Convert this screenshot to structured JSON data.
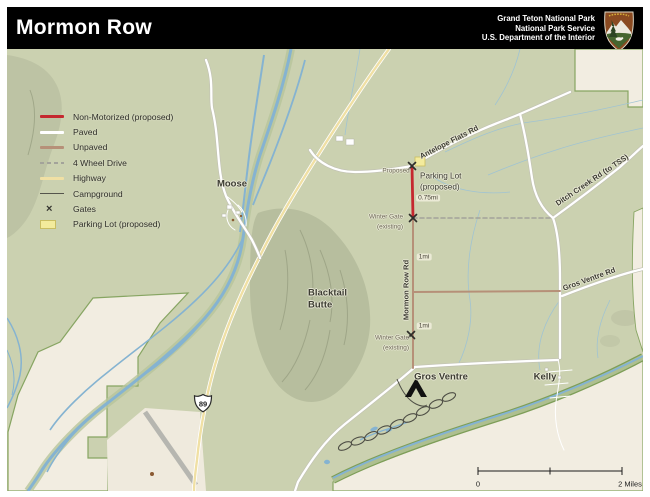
{
  "header": {
    "title": "Mormon Row",
    "agency_lines": [
      "Grand Teton National Park",
      "National Park Service",
      "U.S. Department of the Interior"
    ],
    "logo": "nps-arrowhead-logo"
  },
  "legend": {
    "items": [
      {
        "id": "non-motorized",
        "label": "Non-Motorized (proposed)",
        "swatch": "line",
        "color": "#c5282f"
      },
      {
        "id": "paved",
        "label": "Paved",
        "swatch": "line",
        "color": "#ffffff"
      },
      {
        "id": "unpaved",
        "label": "Unpaved",
        "swatch": "line",
        "color": "#b69078"
      },
      {
        "id": "4-wheel-drive",
        "label": "4 Wheel Drive",
        "swatch": "dash",
        "color": "#a3a39a"
      },
      {
        "id": "highway",
        "label": "Highway",
        "swatch": "line",
        "color": "#f0e0a4"
      },
      {
        "id": "campground",
        "label": "Campground",
        "swatch": "thin",
        "color": "#55554c"
      },
      {
        "id": "gates",
        "label": "Gates",
        "swatch": "x",
        "color": "#35352f",
        "glyph": "×"
      },
      {
        "id": "parking-lot",
        "label": "Parking Lot (proposed)",
        "swatch": "rect",
        "color": "#f3eb9c"
      }
    ]
  },
  "map": {
    "shield_label": "89",
    "scale": {
      "left_label": "0",
      "right_label": "2 Miles"
    },
    "labels": [
      {
        "id": "moose",
        "text": "Moose",
        "x": 232,
        "y": 184,
        "rot": 0,
        "cls": "place",
        "anchor": "m"
      },
      {
        "id": "antelope-flats-rd",
        "text": "Antelope Flats Rd",
        "x": 449,
        "y": 142,
        "rot": -27,
        "cls": "road",
        "anchor": "m"
      },
      {
        "id": "ditch-creek-rd",
        "text": "Ditch Creek Rd (to TSS)",
        "x": 592,
        "y": 180,
        "rot": -34,
        "cls": "road",
        "anchor": "m"
      },
      {
        "id": "proposed-gate",
        "text": "Proposed",
        "x": 396,
        "y": 171,
        "rot": 0,
        "cls": "tiny",
        "anchor": "m"
      },
      {
        "id": "parking-lot-1",
        "text": "Parking Lot",
        "x": 420,
        "y": 176,
        "rot": 0,
        "cls": "med",
        "anchor": "l"
      },
      {
        "id": "parking-lot-2",
        "text": "(proposed)",
        "x": 420,
        "y": 187,
        "rot": 0,
        "cls": "med",
        "anchor": "l"
      },
      {
        "id": "dist-075mi",
        "text": "0.75mi",
        "x": 428,
        "y": 198,
        "rot": 0,
        "cls": "dist",
        "anchor": "m"
      },
      {
        "id": "winter-gate-1a",
        "text": "Winter Gate",
        "x": 386,
        "y": 217,
        "rot": 0,
        "cls": "tiny",
        "anchor": "m"
      },
      {
        "id": "winter-gate-1b",
        "text": "(existing)",
        "x": 390,
        "y": 227,
        "rot": 0,
        "cls": "tiny",
        "anchor": "m"
      },
      {
        "id": "mormon-row-rd",
        "text": "Mormon Row Rd",
        "x": 406,
        "y": 290,
        "rot": -90,
        "cls": "road",
        "anchor": "m"
      },
      {
        "id": "dist-1mi-a",
        "text": "1mi",
        "x": 424,
        "y": 257,
        "rot": 0,
        "cls": "dist",
        "anchor": "m"
      },
      {
        "id": "dist-1mi-b",
        "text": "1mi",
        "x": 424,
        "y": 326,
        "rot": 0,
        "cls": "dist",
        "anchor": "m"
      },
      {
        "id": "winter-gate-2a",
        "text": "Winter Gate",
        "x": 392,
        "y": 338,
        "rot": 0,
        "cls": "tiny",
        "anchor": "m"
      },
      {
        "id": "winter-gate-2b",
        "text": "(existing)",
        "x": 396,
        "y": 348,
        "rot": 0,
        "cls": "tiny",
        "anchor": "m"
      },
      {
        "id": "gros-ventre-rd",
        "text": "Gros Ventre Rd",
        "x": 589,
        "y": 279,
        "rot": -20,
        "cls": "road",
        "anchor": "m"
      },
      {
        "id": "blacktail-1",
        "text": "Blacktail",
        "x": 308,
        "y": 293,
        "rot": 0,
        "cls": "place",
        "anchor": "l"
      },
      {
        "id": "blacktail-2",
        "text": "Butte",
        "x": 308,
        "y": 305,
        "rot": 0,
        "cls": "place",
        "anchor": "l"
      },
      {
        "id": "gros-ventre-cg",
        "text": "Gros Ventre",
        "x": 441,
        "y": 377,
        "rot": 0,
        "cls": "place",
        "anchor": "m"
      },
      {
        "id": "kelly",
        "text": "Kelly",
        "x": 545,
        "y": 377,
        "rot": 0,
        "cls": "place",
        "anchor": "m"
      },
      {
        "id": "scale-left",
        "text": "0",
        "x": 478,
        "y": 484,
        "rot": 0,
        "cls": "scale",
        "anchor": "m"
      },
      {
        "id": "scale-right",
        "text": "2 Miles",
        "x": 630,
        "y": 484,
        "rot": 0,
        "cls": "scale",
        "anchor": "m"
      }
    ],
    "colors": {
      "land": "#cbd1b0",
      "outside_park": "#f2ede1",
      "water": "#85b3d1",
      "boundary": "#87a562",
      "highway": "#f0e0a4",
      "paved": "#ffffff",
      "unpaved": "#b69078",
      "four_wheel": "#a3a39a",
      "proposed_red": "#c5282f",
      "parking_yellow": "#f3eb9c"
    }
  }
}
